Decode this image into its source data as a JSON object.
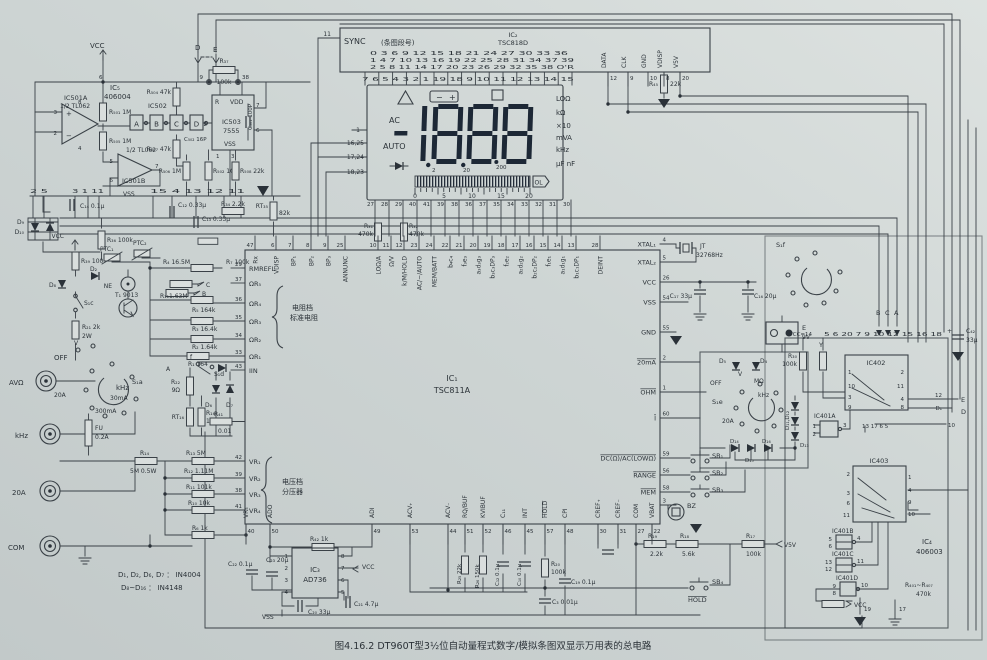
{
  "colors": {
    "paper_light": "#dde2e0",
    "paper_dark": "#c2c9c9",
    "ink": "#3a4147",
    "digit": "#1d2836",
    "lcd": "#dbe0da"
  },
  "caption": "图4.16.2   DT960T型3½位自动量程式数字/模拟条图双显示万用表的总电路",
  "ic2": {
    "pin11": "11",
    "sync": "SYNC",
    "seg_note": "(条图段号)",
    "name": "IC₂",
    "part": "TSC818D",
    "row1": "0   3   6   9   12  15  18  21  24  27  30  33  36",
    "row2": "1   4   7   10  13  16  19  22  25  28  31  34  37    39",
    "row3": "2   5   8   11  14  17  20  23  26  29  32  35  38    O'R",
    "bottom_pins": "7   6   5   4   3   2   1   19  18   9   10  11  12  13  14  15",
    "pins": [
      {
        "n": "12",
        "l": "DATA"
      },
      {
        "n": "9",
        "l": "CLK"
      },
      {
        "n": "10",
        "l": "GND"
      },
      {
        "n": "8",
        "l": "VDISP"
      },
      {
        "n": "20",
        "l": "V5V"
      }
    ],
    "r45a": "R₄₅",
    "r45b": "22k"
  },
  "lcd": {
    "bat_minus": "−",
    "bat_plus": "+",
    "ac": "AC",
    "auto": "AUTO",
    "ann": [
      "LOΩ",
      "kΩ",
      "×10",
      "mVA",
      "kHz",
      "µF nF"
    ],
    "ranges": [
      "2",
      "20",
      "200"
    ],
    "scale": [
      "0",
      "5",
      "10",
      "15",
      "20"
    ],
    "ol": "OL",
    "left_pins": [
      "1",
      "16,25",
      "17,24",
      "18,23"
    ]
  },
  "ic1": {
    "name": "IC₁",
    "part": "TSC811A",
    "r31a": "R₃₁",
    "r31b": "470k",
    "r32a": "R₃₂",
    "r32b": "470k",
    "lcd_pins": [
      "27",
      "28",
      "29",
      "40",
      "41",
      "39",
      "38",
      "36",
      "37",
      "35",
      "34",
      "33",
      "32",
      "31",
      "30"
    ],
    "top": [
      {
        "n": "47",
        "l": "Rx"
      },
      {
        "n": "6",
        "l": "VDISP"
      },
      {
        "n": "7",
        "l": "BP₁"
      },
      {
        "n": "8",
        "l": "BP₂"
      },
      {
        "n": "9",
        "l": "BP₃"
      },
      {
        "n": "25",
        "l": "ANNUNC"
      },
      {
        "n": "10",
        "l": "LOΩ/A"
      },
      {
        "n": "11",
        "l": "Ω/V"
      },
      {
        "n": "12",
        "l": "k/M/HOLD"
      },
      {
        "n": "23",
        "l": "AC/−/AUTO"
      },
      {
        "n": "24",
        "l": "MEM/BATT"
      },
      {
        "n": "22",
        "l": "b₄c₄"
      },
      {
        "n": "21",
        "l": "f₃e₃"
      },
      {
        "n": "20",
        "l": "a₃d₃g₃"
      },
      {
        "n": "19",
        "l": "b₃c₃DP₃"
      },
      {
        "n": "18",
        "l": "f₂e₂"
      },
      {
        "n": "17",
        "l": "a₂d₂g₂"
      },
      {
        "n": "16",
        "l": "b₂c₂DP₂"
      },
      {
        "n": "15",
        "l": "f₁e₁"
      },
      {
        "n": "14",
        "l": "a₁d₁g₁"
      },
      {
        "n": "13",
        "l": "b₁c₁DP₁"
      },
      {
        "n": "28",
        "l": "DEINT"
      }
    ],
    "left": [
      {
        "n": "29",
        "l": "RMREFL"
      },
      {
        "n": "37",
        "l": "ΩR₅"
      },
      {
        "n": "36",
        "l": "ΩR₄"
      },
      {
        "n": "35",
        "l": "ΩR₃"
      },
      {
        "n": "34",
        "l": "ΩR₂"
      },
      {
        "n": "33",
        "l": "ΩR₁"
      },
      {
        "n": "43",
        "l": "IIN"
      },
      {
        "n": "42",
        "l": "VR₁"
      },
      {
        "n": "39",
        "l": "VR₂"
      },
      {
        "n": "38",
        "l": "VR₃"
      },
      {
        "n": "41",
        "l": "VR₄"
      }
    ],
    "bottom": [
      {
        "n": "40",
        "l": "VR₅"
      },
      {
        "n": "50",
        "l": "ADO"
      },
      {
        "n": "49",
        "l": "ADI"
      },
      {
        "n": "53",
        "l": "ACV₊"
      },
      {
        "n": "44",
        "l": "ACV₋"
      },
      {
        "n": "51",
        "l": "RQ/BUF"
      },
      {
        "n": "52",
        "l": "KVIBUF"
      },
      {
        "n": "46",
        "l": "C₁₁"
      },
      {
        "n": "45",
        "l": "INT"
      },
      {
        "n": "57",
        "l": "HOLD",
        "o": 1
      },
      {
        "n": "48",
        "l": "CPI"
      },
      {
        "n": "30",
        "l": "CREF₊"
      },
      {
        "n": "31",
        "l": "CREF₋"
      },
      {
        "n": "27",
        "l": "COM"
      },
      {
        "n": "22",
        "l": "VBAT"
      }
    ],
    "right": [
      {
        "n": "4",
        "l": "XTAL₁"
      },
      {
        "n": "5",
        "l": "XTAL₂"
      },
      {
        "n": "26",
        "l": "VCC"
      },
      {
        "n": "54",
        "l": "VSS"
      },
      {
        "n": "55",
        "l": "GND"
      },
      {
        "n": "2",
        "l": "20mA",
        "o": 1
      },
      {
        "n": "1",
        "l": "OHM",
        "o": 1
      },
      {
        "n": "60",
        "l": "I",
        "o": 1
      },
      {
        "n": "59",
        "l": "DC(Ω)/AC(LOWΩ)",
        "o": 1
      },
      {
        "n": "56",
        "l": "RANGE",
        "o": 1
      },
      {
        "n": "58",
        "l": "MEM",
        "o": 1
      },
      {
        "n": "3",
        "l": ""
      }
    ],
    "res_brace1": "电阻档",
    "res_brace2": "标准电阻",
    "div_brace1": "电压档",
    "div_brace2": "分压器"
  },
  "tl": {
    "vcc": "VCC",
    "d": "D",
    "e": "E",
    "p9": "9",
    "p38": "38",
    "p6": "6",
    "r37a": "R₃₇",
    "r37b": "100k",
    "ic5a": "IC₅",
    "ic5b": "406004",
    "ic501a1": "IC501A",
    "ic501a2": "1/2 TL062",
    "p3": "3",
    "p2": "2",
    "p8": "8",
    "p4": "4",
    "ic502": "IC502",
    "ga": "A",
    "gb": "B",
    "gc": "C",
    "gd": "D",
    "c502": "C₅₀₂ 16P",
    "ic503r": "R",
    "ic503vdd": "VDD",
    "ic503a": "IC503",
    "ic503b": "7555",
    "ic503vss": "VSS",
    "p7": "7",
    "p6b": "6",
    "p2b": "2",
    "p1": "1",
    "p3b": "3",
    "r504": "R₅₀₄ 47k",
    "r501": "R₅₀₁ 1M",
    "r505": "R₅₀₅ 1M",
    "r507": "R₅₀₇ 47k",
    "ic501b1": "1/2 TL062",
    "ic501b2": "IC501B",
    "p5": "5",
    "p6c": "6",
    "p7b": "7",
    "r506": "R₅₀₆ 1M",
    "r502": "R₅₀₂ 10k",
    "r508": "R₅₀₈ 22k",
    "c501": "C₅₀₁ 100P",
    "pins1": "2   5",
    "pins2": "3   1   11",
    "pins3": "15     4     13    12    11",
    "c14": "C₁₄ 0.1µ",
    "c12": "C₁₂ 0.33µ",
    "c13": "C₁₃ 0.33µ",
    "r34": "R₃₄ 2.2k",
    "rt35a": "RT₃₅",
    "rt35b": "82k",
    "d9": "D₉",
    "d10": "D₁₀",
    "r36": "R₃₆ 100k",
    "vss": "VSS"
  },
  "lf": {
    "vcc": "VCC",
    "r39": "R₃₉ 100",
    "d2": "D₂",
    "d8": "D₈",
    "s1c": "S₁c",
    "r21a": "R₂₁ 2k",
    "r21b": "2W",
    "ptc1": "PTC₁",
    "ptc2": "PTC₂",
    "ne": "NE",
    "t1": "T₁  9013",
    "r4": "R₄ 16.5M",
    "r7": "R₇ 100k",
    "c": "C",
    "b": "B",
    "a": "A",
    "f": "f",
    "r11": "R₁₁1.63M",
    "r5": "R₅ 164k",
    "r3": "R₃ 16.4k",
    "r2": "R₂ 1.64k",
    "r1": "R₁ 164",
    "s1a": "S₁a",
    "v": "V",
    "off": "OFF",
    "khz": "kHz",
    "ma30": "30mA",
    "ma300": "300mA",
    "a20": "20A",
    "fua": "FU",
    "fub": "0.2A",
    "s1d": "S₁d",
    "r22a": "R₂₂",
    "r22b": "9Ω",
    "d6": "D₆",
    "d7": "D₇",
    "rt16": "RT₁₆",
    "r16a": "R₁₆",
    "r16b": "1",
    "r41a": "R₄₁",
    "r41b": "0.01",
    "jack_avo": "AVΩ",
    "jack_khz": "kHz",
    "jack_20a": "20A",
    "jack_com": "COM",
    "r14a": "R₁₄",
    "r14b": "5M  0.5W",
    "r13": "R₁₃  5M",
    "r12": "R₁₂  1.11M",
    "r11b": "R₁₁  101k",
    "r10": "R₁₀  10k",
    "r6": "R₆ 1k",
    "note1": "D₁, D₂, D₆, D₇ ： IN4004",
    "note2": "D₈~D₁₆ ： IN4148"
  },
  "bt": {
    "r42": "R₄₂  1k",
    "ic3a": "IC₃",
    "ic3b": "AD736",
    "p1": "1",
    "p2": "2",
    "p3": "3",
    "p4": "4",
    "p5": "5",
    "p6": "6",
    "p7": "7",
    "p8": "8",
    "vcc": "VCC",
    "c21": "C₂₁ 4.7µ",
    "c20": "C₂₀ 33µ",
    "vss": "VSS",
    "c22": "C₂₂ 0.1µ",
    "c23": "C₂₃ 20µ",
    "r25": "R₂₅ 22k",
    "r26": "R₂₆ 150k",
    "c12": "C₁₂ 0.1µ",
    "c10": "C₁₀ 0.1µ",
    "r20a": "R₂₀",
    "r20b": "100k",
    "c3": "C₃ 0.01µ",
    "c19": "C₁₉ 0.1µ",
    "sb1": "SB₁",
    "sb2": "SB₂",
    "sb3": "SB₃",
    "sb4": "SB₄",
    "hold": "HOLD",
    "bz": "BZ",
    "p3bz": "3",
    "r19a": "R₁₉",
    "r19b": "2.2k",
    "r18a": "R₁₈",
    "r18b": "5.6k",
    "r17a": "R₁₇",
    "r17b": "100k",
    "v5v": "V5V"
  },
  "rt": {
    "jt": "JT",
    "xtal": "32768Hz",
    "c17": "C₁₇ 33µ",
    "c16": "C₁₆ 20µ",
    "s1f": "S₁f",
    "e": "E",
    "e9v": "9V",
    "r30a": "R₃₀",
    "r30b": "100k",
    "y": "Y",
    "b": "B",
    "c": "C",
    "a": "A",
    "vccrow": "VCC=14",
    "prow": "5 6   20   7 9 10   12   15 16 18",
    "c42a": "C₄₂",
    "c42b": "33µ",
    "plus": "+",
    "d5": "D₅",
    "d4": "D₄",
    "v": "V",
    "off": "OFF",
    "mohm": "MΩ",
    "khz": "kHz",
    "a20": "20A",
    "s1e": "S₁e",
    "d1112": "D₁₁,D₁₂",
    "d13": "D₁₃",
    "d14": "D₁₄",
    "d15": "D₁₅",
    "d16": "D₁₆",
    "ic402": "IC402",
    "q1": "1",
    "q2": "2",
    "q10": "10",
    "q11": "11",
    "q3": "3",
    "q4": "4",
    "q9": "9",
    "q8": "8",
    "qrow": "13 17 6  5",
    "o12": "12",
    "oe": "E",
    "od1": "D₁",
    "od": "D",
    "o10": "10",
    "ic401a": "IC401A",
    "a1": "1",
    "a2": "2",
    "a3": "3",
    "ic403": "IC403",
    "w1": "1",
    "w4": "4",
    "w9": "9",
    "w10": "10",
    "w2": "2",
    "w3": "3",
    "w6": "6",
    "w11": "11",
    "ic401b": "IC401B",
    "b5": "5",
    "b6": "6",
    "b4": "4",
    "ic401c": "IC401C",
    "c12p": "12",
    "c13p": "13",
    "c11p": "11",
    "ic401d": "IC401D",
    "d9p": "9",
    "d8p": "8",
    "d10p": "10",
    "vcc": "VCC",
    "ic4a": "IC₄",
    "ic4b": "406003",
    "r401a": "R₄₀₁~R₄₀₇",
    "r401b": "470k",
    "p19": "19",
    "p17": "17"
  }
}
